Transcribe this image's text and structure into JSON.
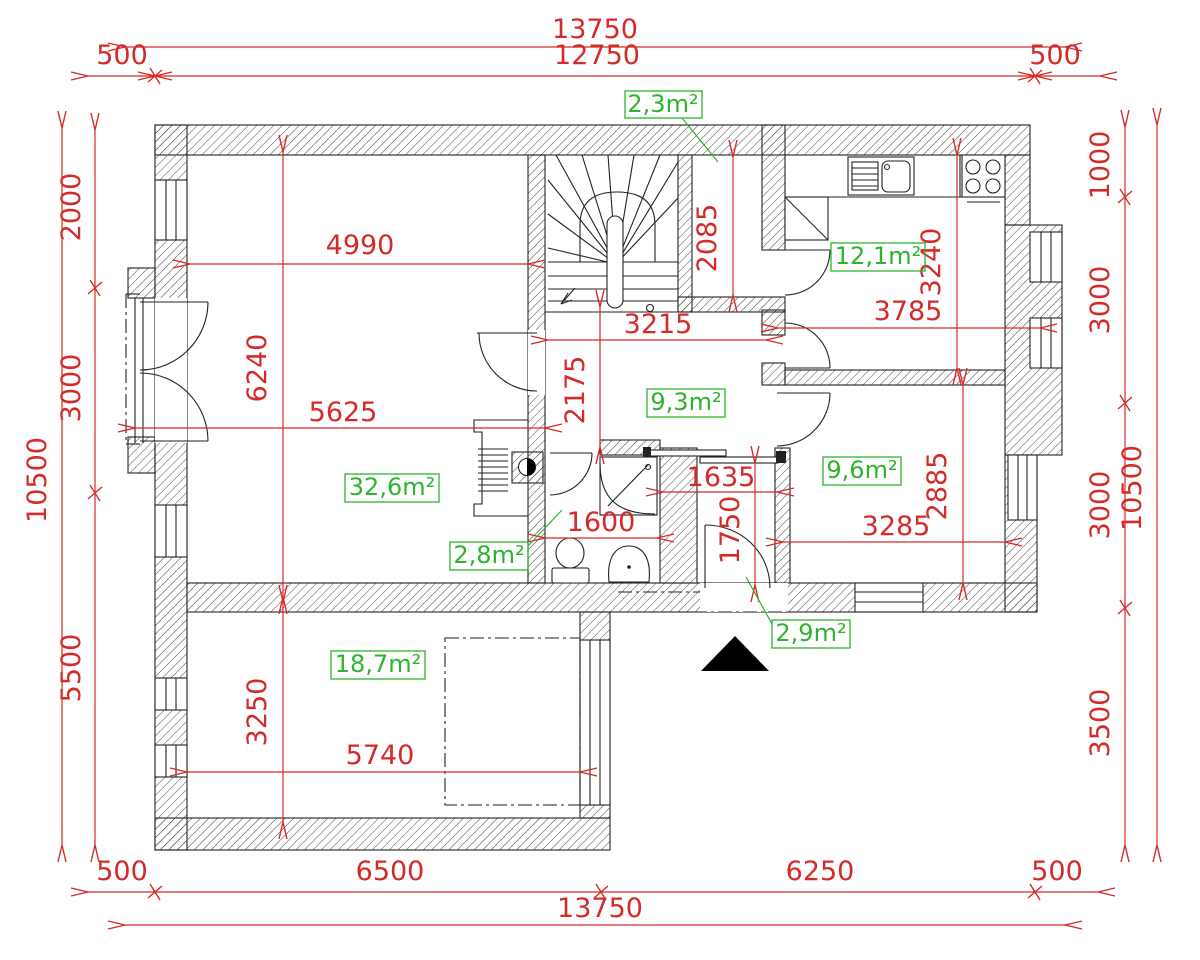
{
  "drawing": {
    "type": "architectural floor plan",
    "units": "mm"
  },
  "colors": {
    "dimension": "#d42a2a",
    "area_label": "#2db32d",
    "walls": "#222222",
    "north_arrow": "#000000"
  },
  "dims": {
    "top": {
      "total": "13750",
      "overhang_left": "500",
      "inner": "12750",
      "overhang_right": "500"
    },
    "bottom": {
      "total": "13750",
      "segments": [
        "500",
        "6500",
        "6250",
        "500"
      ]
    },
    "left": {
      "total": "10500",
      "segments": [
        "2000",
        "3000",
        "5500"
      ]
    },
    "right": {
      "total": "10500",
      "segments": [
        "1000",
        "3000",
        "3000",
        "3500"
      ]
    },
    "interior": {
      "living_width_top": "4990",
      "living_height": "6240",
      "living_width": "5625",
      "hall_width": "3215",
      "hall_height": "2175",
      "closet_height": "2085",
      "kitchen_width": "3785",
      "kitchen_height": "3240",
      "bath_width": "1600",
      "vestibule_width": "1635",
      "vestibule_height": "1750",
      "bedroom_width": "3285",
      "bedroom_height": "2885",
      "bottom_room_width": "5740",
      "bottom_room_height": "3250"
    }
  },
  "areas": {
    "closet": "2,3m²",
    "kitchen": "12,1m²",
    "hall": "9,3m²",
    "living": "32,6m²",
    "bathroom": "2,8m²",
    "bedroom": "9,6m²",
    "vestibule": "2,9m²",
    "bottom_room": "18,7m²"
  }
}
